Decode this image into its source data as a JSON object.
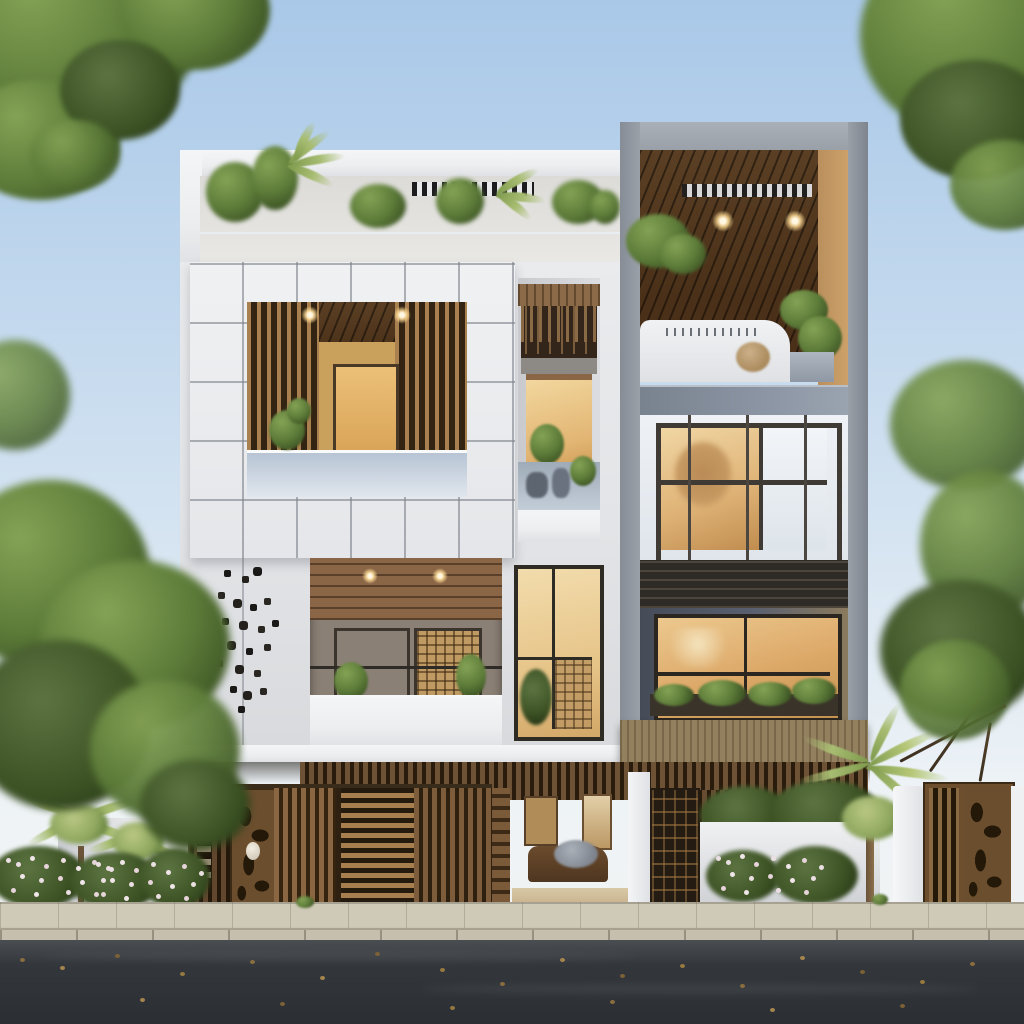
{
  "meta": {
    "domain": "Natural-Image",
    "subject": "Photorealistic architectural rendering of a modern three-storey residence, street-front elevation, daytime",
    "style": "contemporary white facade with wooden slat accents, cantilevered boxes, roof garden, street with compound wall and wooden gates"
  },
  "palette": {
    "sky1": "#a9c8e8",
    "sky2": "#cfe0f0",
    "sky3": "#eef3f6",
    "white": "#eceef0",
    "joint": "#7d838b",
    "wood": "#8a6642",
    "woodL": "#a77e4e",
    "woodD": "#5d4228",
    "woodDeep": "#33230f",
    "ceil1": "#4a3018",
    "warm": "#e0b478",
    "warmD": "#c08c4e",
    "gray": "#8c95a3",
    "frame": "#9aa0a8",
    "louver": "#2e2a25",
    "glass1": "#b7c4d4",
    "glass2": "#e0e6ed",
    "road": "#33373c",
    "roadL": "#565a5f",
    "walk": "#cfc9b8",
    "curb": "#c6bfae",
    "leafD": "#394f22",
    "leaf": "#5d7c39",
    "leafL": "#85a355",
    "palm": "#9ab06a",
    "flower": "#ecdfe4",
    "bushD": "#4b443a",
    "interior": "#c89c5e"
  },
  "scene": {
    "sky": "clear pale-blue sky",
    "trees": [
      "leafy canopy top-left corner",
      "leafy canopy top-right corner",
      "dense garden trees left of house",
      "tree with dark branches right of house"
    ],
    "building": {
      "left_block": {
        "roof_terrace": "white parapet, tropical plants behind frosted-glass planter band, black-and-white slatted vent",
        "tiled_box": "white stone-tile clad box with large square opening; inside: vertical wooden slat screens, dark timber ceiling with two spotlights, amber interior door, glass balcony rail, small tree",
        "wall_art": "cluster of small dark metal butterflies on white wall",
        "lower_veranda": "timber plank ceiling with two downlights, curtained lattice windows, white balcony parapet with plants and thin rail",
        "middle_bay": "recessed balcony with hanging wood slats, warm window, rock-and-glass planter; below, tall warm window with lattice panel and plant"
      },
      "right_block": {
        "frame": "tall gray concrete frame lined with wood, spanning two storeys",
        "top": "sloped dark timber ceiling with two recessed lights, monstera plant, white terrace walls with shrubs",
        "middle": "blue-gray floor band, glazed curtain wall with warm tree reflections",
        "louvers": "dark horizontal louver band",
        "bottom": "large amber window with balcony flower box of trailing plants, wide wood fascia below"
      },
      "ground_floor": {
        "entrance": "open lobby with warm timber panelling and draped furniture",
        "canopy": "dark vertical wooden slat band under cantilever",
        "pillars": "white square pillars flanking gates"
      }
    },
    "street": {
      "left_fence": [
        "vertical slat gate",
        "carved ornamental gate with oval medallion",
        "vertical slat gate",
        "horizontal louver gate",
        "vertical slat gate",
        "ladder-detail jamb"
      ],
      "right_fence": [
        "dark lattice gate",
        "low white garden wall with flower bed",
        "palm tree",
        "white pillar",
        "carved wooden double gate",
        "white pillar"
      ],
      "left_garden": "white curved wall, flowering shrubs in white and pink, two small palms",
      "sidewalk": "beige stone pavers with fan-pattern joints and small weeds",
      "road": "dark asphalt scattered with fallen brown leaves"
    }
  }
}
